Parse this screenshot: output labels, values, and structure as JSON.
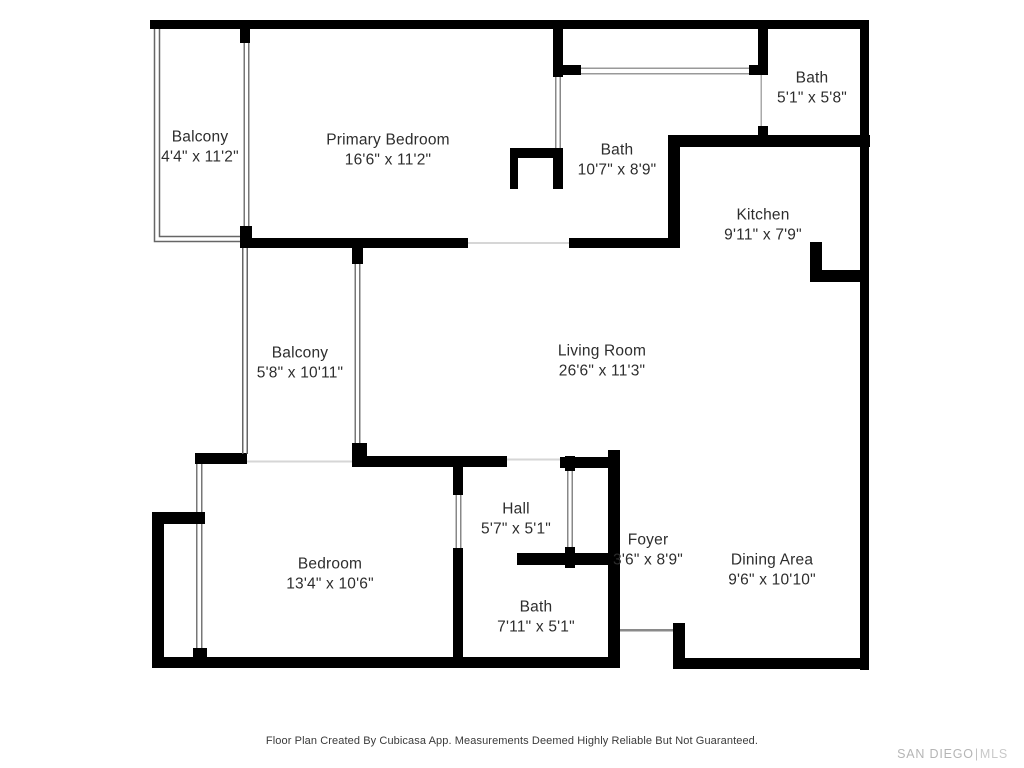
{
  "title": "Floor Plan",
  "rooms": [
    {
      "name": "Balcony",
      "dims": "4'4\" x 11'2\""
    },
    {
      "name": "Primary Bedroom",
      "dims": "16'6\" x 11'2\""
    },
    {
      "name": "Bath",
      "dims": "5'1\" x 5'8\""
    },
    {
      "name": "Bath",
      "dims": "10'7\" x 8'9\""
    },
    {
      "name": "Kitchen",
      "dims": "9'11\" x 7'9\""
    },
    {
      "name": "Balcony",
      "dims": "5'8\" x 10'11\""
    },
    {
      "name": "Living Room",
      "dims": "26'6\" x 11'3\""
    },
    {
      "name": "Hall",
      "dims": "5'7\" x 5'1\""
    },
    {
      "name": "Foyer",
      "dims": "3'6\" x 8'9\""
    },
    {
      "name": "Bedroom",
      "dims": "13'4\" x 10'6\""
    },
    {
      "name": "Dining Area",
      "dims": "9'6\" x 10'10\""
    },
    {
      "name": "Bath",
      "dims": "7'11\" x 5'1\""
    }
  ],
  "footer": {
    "disclaimer": "Floor Plan Created By Cubicasa App. Measurements Deemed Highly Reliable But Not Guaranteed."
  },
  "logo": {
    "primary": "SAN DIEGO",
    "separator": "|",
    "secondary": "MLS"
  },
  "colors": {
    "wall": "#000000",
    "railing": "#666666",
    "door_line": "#888888",
    "opening_line": "#d6d6d6",
    "threshold": "#8a8a8a",
    "text": "#2d2d2d",
    "footer_text": "#3a3a3a",
    "logo": "#b5b5b5",
    "background": "#ffffff"
  }
}
